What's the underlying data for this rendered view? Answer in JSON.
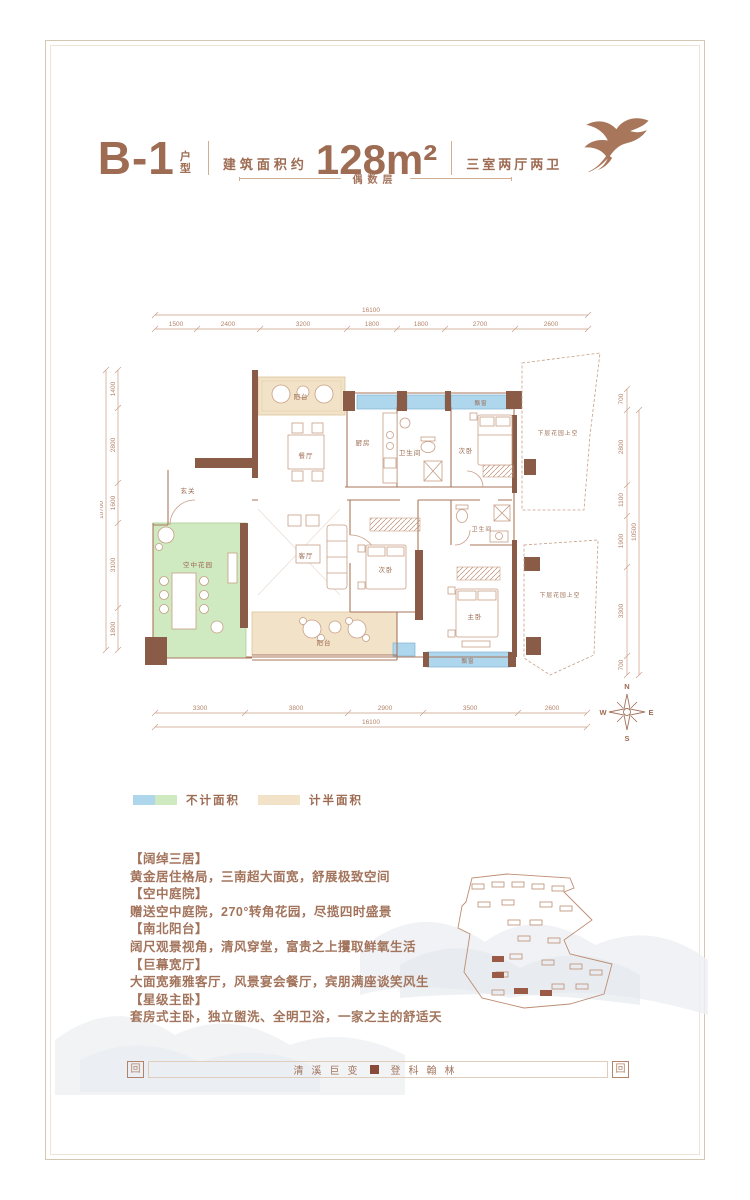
{
  "colors": {
    "accent": "#a3745c",
    "wall": "#8a5c47",
    "blue": "#aed6ec",
    "green": "#cfe9c0",
    "tan": "#f2e3c8",
    "seal": "#8a4a3a"
  },
  "header": {
    "unit": "B-1",
    "unit_suffix": "户型",
    "area_prefix": "建筑面积约",
    "area": "128m²",
    "rooms_summary": "三室两厅两卫",
    "floor_note": "偶数层"
  },
  "plan": {
    "labels": [
      "阳台",
      "餐厅",
      "厨房",
      "卫生间",
      "次卧",
      "飘窗",
      "下层花园上空",
      "玄关",
      "空中花园",
      "客厅",
      "次卧",
      "卫生间",
      "主卧",
      "阳台",
      "飘窗",
      "下层花园上空"
    ],
    "dims": {
      "top": {
        "total": "16100",
        "segments": [
          "1500",
          "2400",
          "3200",
          "1800",
          "1800",
          "2700",
          "2600"
        ]
      },
      "bottom": {
        "total": "16100",
        "segments": [
          "3300",
          "3800",
          "2900",
          "3500",
          "2600"
        ]
      },
      "left": {
        "total": "10700",
        "segments": [
          "1400",
          "2800",
          "1600",
          "3100",
          "1800"
        ]
      },
      "right": {
        "total": "10500",
        "segments": [
          "700",
          "2800",
          "1100",
          "1900",
          "3300",
          "700"
        ]
      }
    },
    "compass": {
      "n": "N",
      "e": "E",
      "s": "S",
      "w": "W"
    }
  },
  "legend": {
    "items": [
      {
        "label": "不计面积"
      },
      {
        "label": "计半面积"
      }
    ]
  },
  "features": [
    "【阔绰三居】",
    "黄金居住格局，三南超大面宽，舒展极致空间",
    "【空中庭院】",
    "赠送空中庭院，270°转角花园，尽揽四时盛景",
    "【南北阳台】",
    "阔尺观景视角，清风穿堂，富贵之上攫取鲜氧生活",
    "【巨幕宽厅】",
    "大面宽雍雅客厅，风景宴会餐厅，宾朋满座谈笑风生",
    "【星级主卧】",
    "套房式主卧，独立盥洗、全明卫浴，一家之主的舒适天"
  ],
  "footer": {
    "left_text": "清溪巨变",
    "right_text": "登科翰林",
    "seal_glyph": "回"
  }
}
